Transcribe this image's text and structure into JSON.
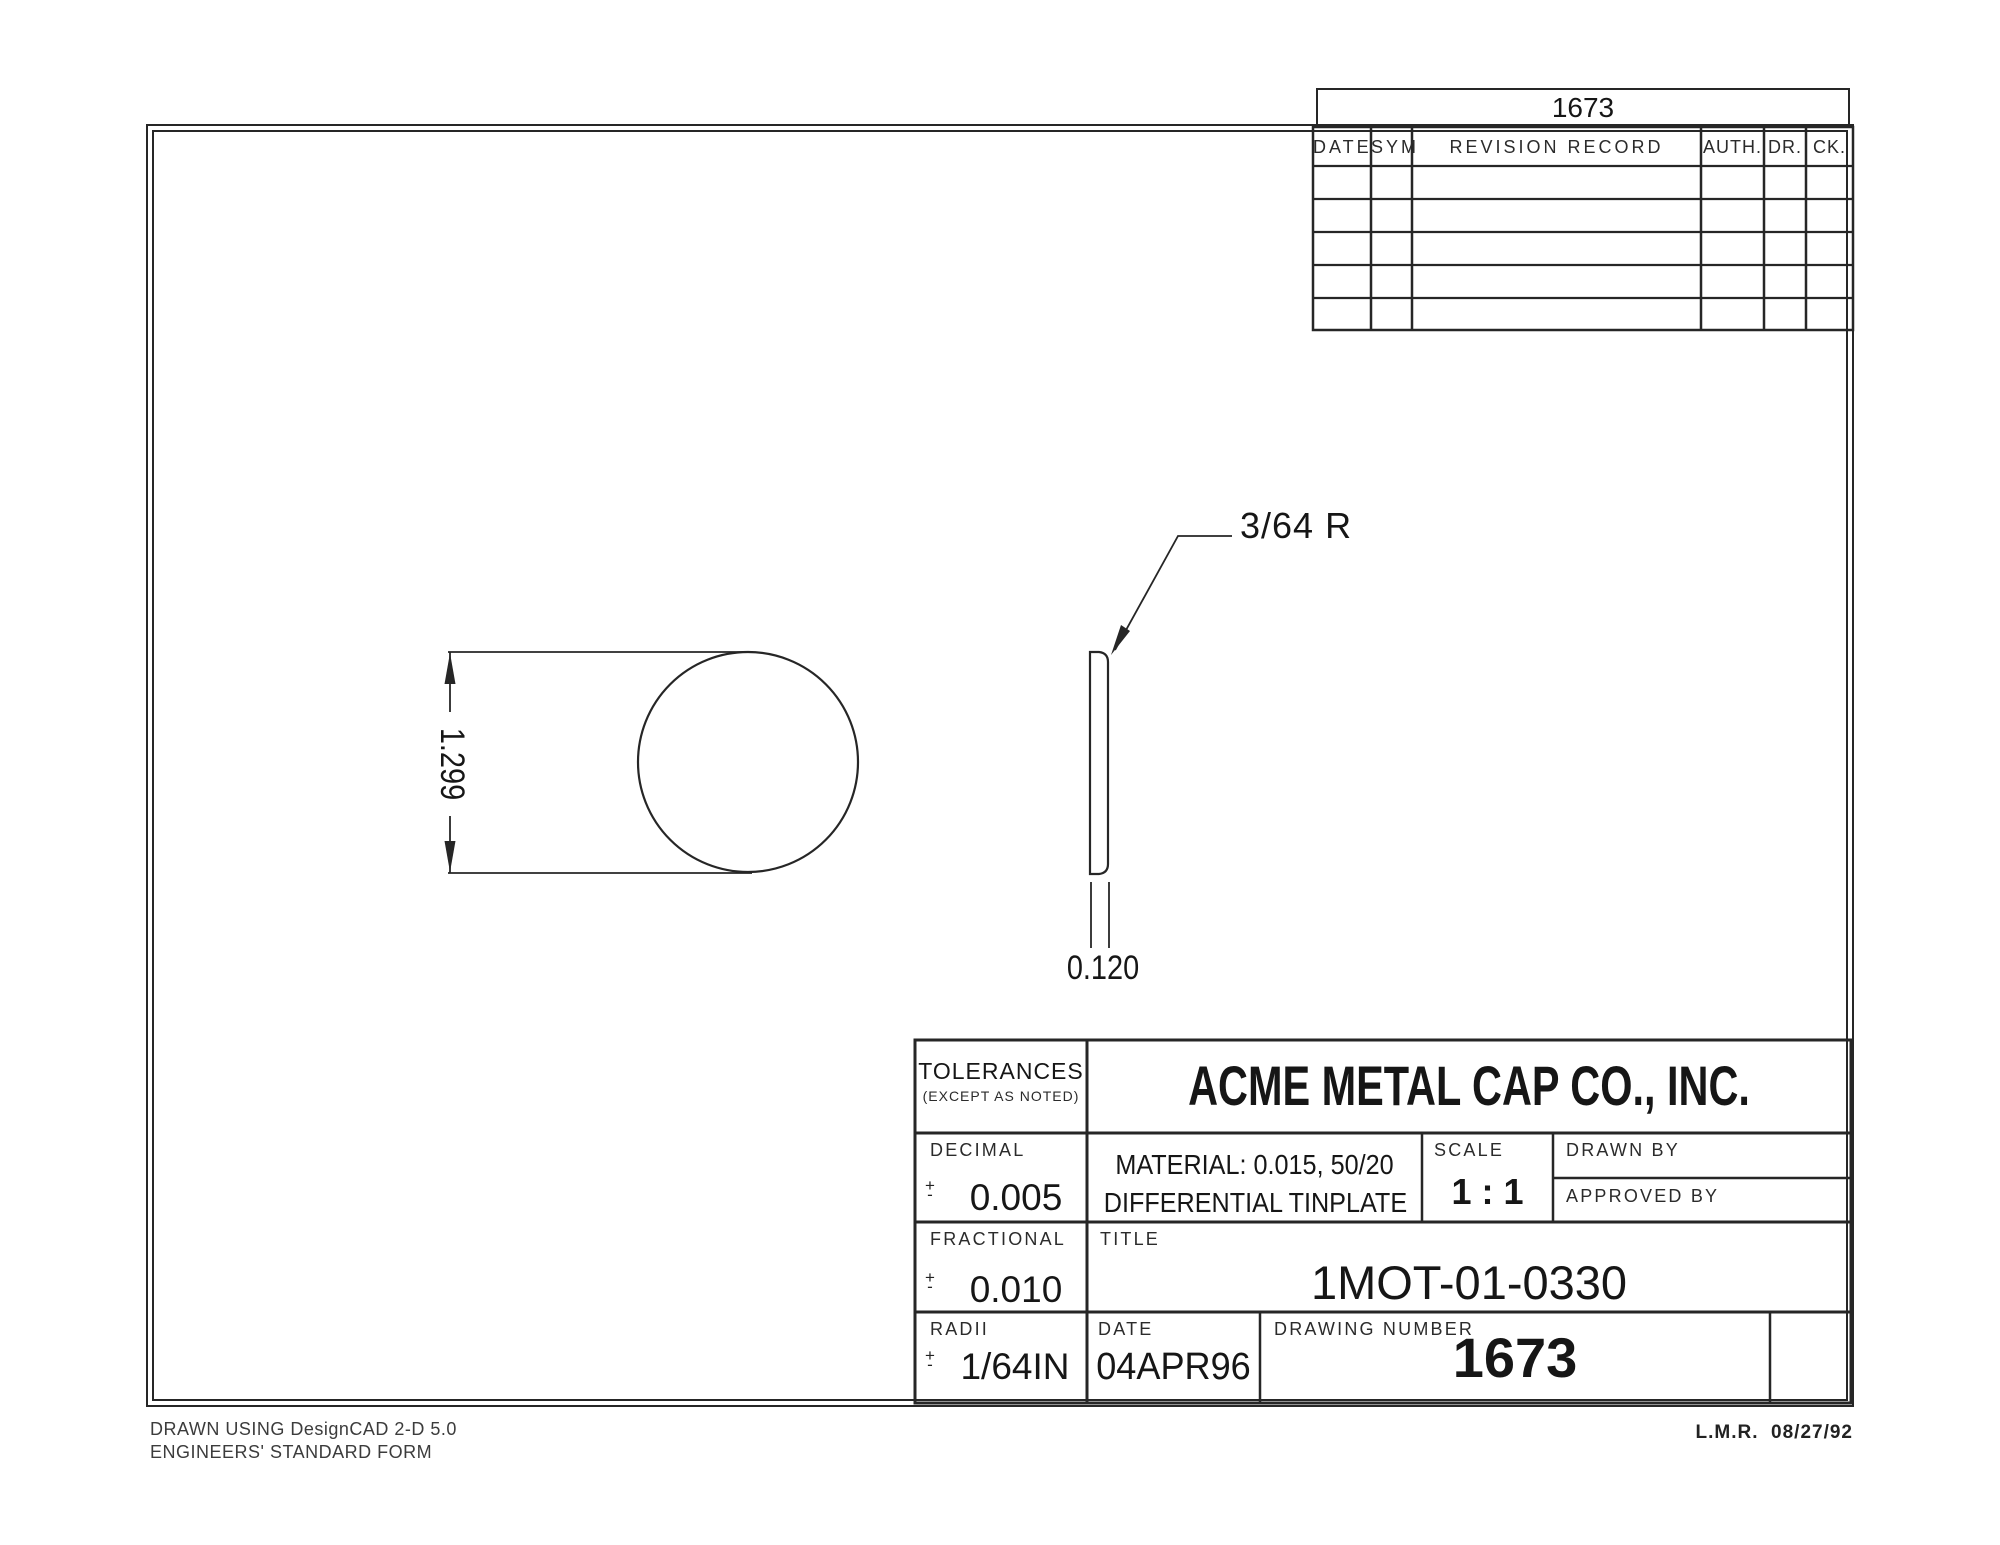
{
  "revision_table": {
    "header_number": "1673",
    "columns": [
      "DATE",
      "SYM",
      "REVISION RECORD",
      "AUTH.",
      "DR.",
      "CK."
    ],
    "empty_row_count": 5
  },
  "drawing_view": {
    "diameter_dimension": "1.299",
    "thickness_dimension": "0.120",
    "radius_callout": "3/64 R"
  },
  "title_block": {
    "tolerances_label": "TOLERANCES",
    "tolerances_note": "(EXCEPT AS NOTED)",
    "company": "ACME METAL CAP CO., INC.",
    "pm": {
      "top": "+",
      "bottom": "-"
    },
    "decimal_label": "DECIMAL",
    "decimal_value": "0.005",
    "material_line1": "MATERIAL: 0.015, 50/20",
    "material_line2": "DIFFERENTIAL TINPLATE",
    "scale_label": "SCALE",
    "scale_value": "1 : 1",
    "drawn_by_label": "DRAWN BY",
    "approved_by_label": "APPROVED BY",
    "fractional_label": "FRACTIONAL",
    "fractional_value": "0.010",
    "title_label": "TITLE",
    "title_value": "1MOT-01-0330",
    "radii_label": "RADII",
    "radii_value": "1/64IN",
    "date_label": "DATE",
    "date_value": "04APR96",
    "drawing_number_label": "DRAWING NUMBER",
    "drawing_number_value": "1673"
  },
  "footer": {
    "left_line1": "DRAWN USING DesignCAD 2-D 5.0",
    "left_line2": "ENGINEERS' STANDARD FORM",
    "right_note": "L.M.R.  08/27/92"
  }
}
